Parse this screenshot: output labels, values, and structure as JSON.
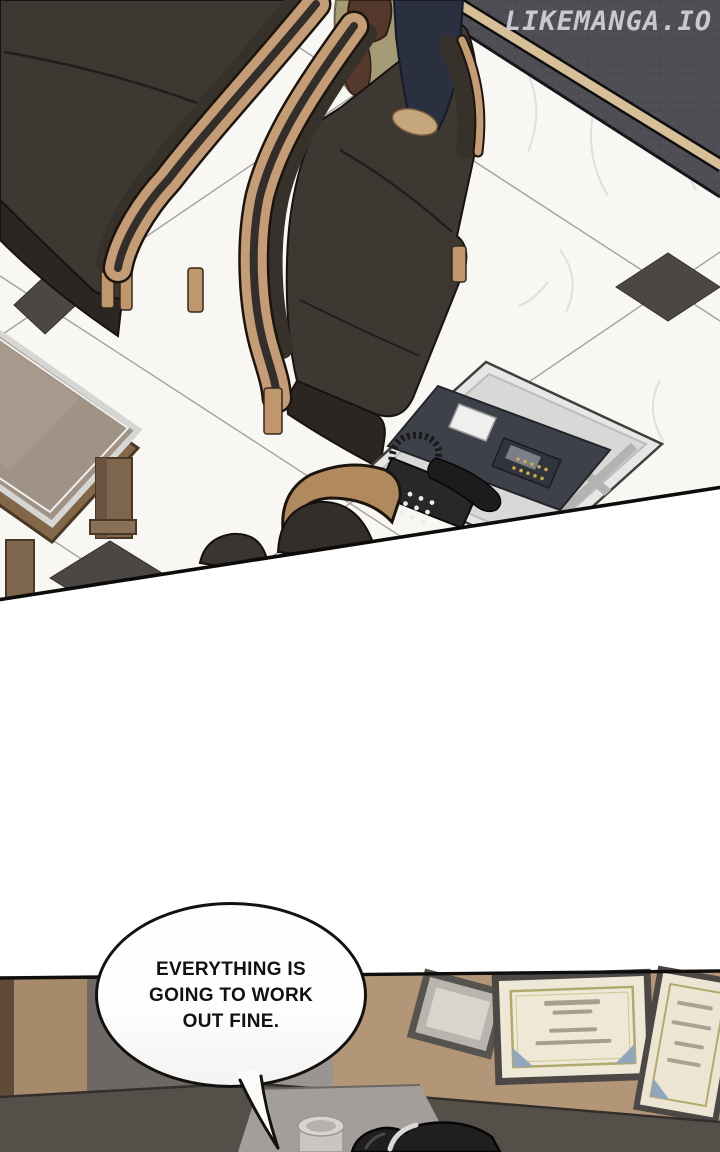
{
  "watermark": {
    "text": "LIKEMANGA.IO"
  },
  "bubble": {
    "text": "EVERYTHING IS\nGOING TO WORK\nOUT FINE."
  },
  "palette": {
    "marble": "#f8f7f4",
    "grout": "#a3a2a0",
    "tile_dark": "#4b4745",
    "dark_floor_corner": "#4f4e54",
    "floor_stripe_tan": "#d7bf98",
    "chair_fabric": "#3e3833",
    "chair_fabric_shadow": "#2b2622",
    "wood_trim": "#c49d76",
    "table_glass": "#a09284",
    "table_wood": "#826749",
    "desk_top": "#e6e6e4",
    "desk_panel_navy": "#3e4149",
    "device_gold": "#c9aa52",
    "office_chair_tan": "#b1895f",
    "person_shirt_olive": "#a59b74",
    "person_hair_brown": "#54382c",
    "person_pants_navy": "#2b3040",
    "wall_tan": "#b39678",
    "counter_gray": "#554f4a",
    "certificate_paper": "#efe8d6",
    "certificate_frame": "#4c4846",
    "certificate_corner_blue": "#8fa6bc",
    "ink": "#141210",
    "watermark_gray": "#c9c8cc"
  }
}
